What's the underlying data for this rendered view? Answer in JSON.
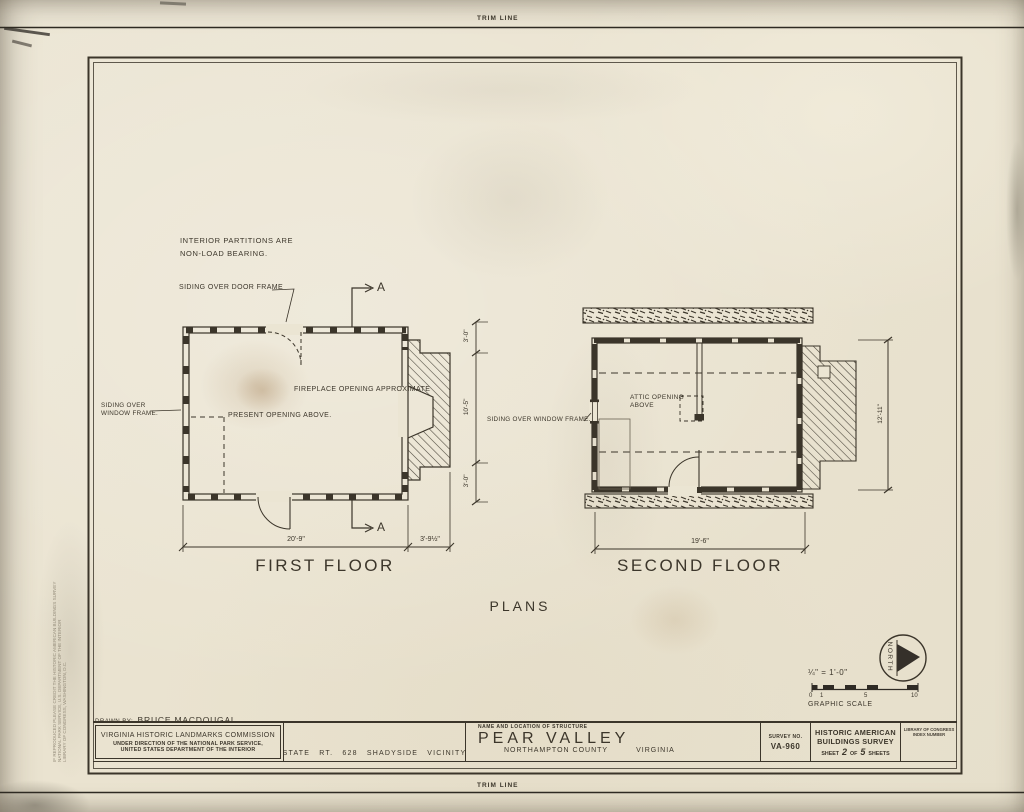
{
  "colors": {
    "ink": "#3b352a",
    "paper": "#ebe5d3"
  },
  "sheet": {
    "trim_label": "TRIM LINE"
  },
  "notes": {
    "partitions_line1": "INTERIOR PARTITIONS ARE",
    "partitions_line2": "NON-LOAD BEARING.",
    "siding_door": "SIDING OVER DOOR FRAME",
    "siding_window_ff_1": "SIDING OVER",
    "siding_window_ff_2": "WINDOW FRAME.",
    "siding_window_sf": "SIDING OVER WINDOW FRAME.",
    "fireplace": "FIREPLACE OPENING APPROXIMATE",
    "present_opening": "PRESENT OPENING ABOVE.",
    "attic_line1": "ATTIC OPENING",
    "attic_line2": "ABOVE",
    "section_letter": "A"
  },
  "plans": {
    "first_floor": "FIRST FLOOR",
    "second_floor": "SECOND FLOOR",
    "sheet_title": "PLANS"
  },
  "dims": {
    "ff_width": "20'-9\"",
    "ff_chimney": "3'-9½\"",
    "side_top": "3'-0\"",
    "side_middle": "10'-5\"",
    "side_bottom": "3'-0\"",
    "sf_width": "19'-6\"",
    "sf_depth": "12'-11\""
  },
  "north_label": "NORTH",
  "scale": {
    "ratio": "¼\" = 1'-0\"",
    "ticks": [
      "0",
      "1",
      "5",
      "10"
    ],
    "label": "GRAPHIC SCALE"
  },
  "titleblock": {
    "drawn_by_label": "DRAWN BY:",
    "drawn_by_name": "BRUCE MACDOUGAL",
    "commission": "VIRGINIA HISTORIC LANDMARKS COMMISSION",
    "direction1": "UNDER DIRECTION OF THE NATIONAL PARK SERVICE,",
    "direction2": "UNITED STATES DEPARTMENT OF THE INTERIOR",
    "location": "STATE RT. 628   SHADYSIDE VICINITY",
    "name_header": "NAME AND LOCATION OF STRUCTURE",
    "structure_name": "PEAR VALLEY",
    "structure_county": "NORTHAMPTON COUNTY",
    "structure_state": "VIRGINIA",
    "survey_no_label": "SURVEY NO.",
    "survey_no": "VA-960",
    "habs1": "HISTORIC AMERICAN",
    "habs2": "BUILDINGS SURVEY",
    "sheet_pre": "SHEET",
    "sheet_num": "2",
    "sheet_of": "OF",
    "sheet_total": "5",
    "sheet_post": "SHEETS",
    "loc1": "LIBRARY OF CONGRESS",
    "loc2": "INDEX NUMBER"
  },
  "stamp": {
    "line1": "IF REPRODUCED PLEASE CREDIT THE HISTORIC AMERICAN BUILDINGS SURVEY",
    "line2": "NATIONAL PARK SERVICE, U.S. DEPARTMENT OF THE INTERIOR",
    "line3": "LIBRARY OF CONGRESS, WASHINGTON, D.C."
  }
}
